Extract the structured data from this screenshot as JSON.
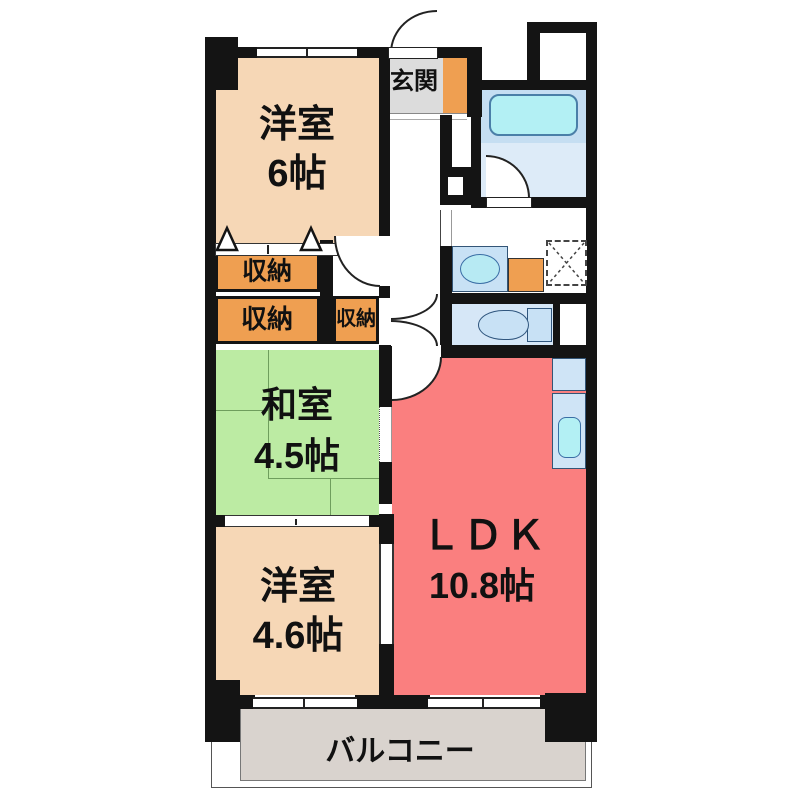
{
  "plan_title": "間取り図",
  "rooms": {
    "entrance": {
      "label": "玄関"
    },
    "western_room_6": {
      "label": "洋室",
      "size": "6帖"
    },
    "storage_1": {
      "label": "収納"
    },
    "storage_2": {
      "label": "収納"
    },
    "storage_3": {
      "label": "収納"
    },
    "japanese_room": {
      "label": "和室",
      "size": "4.5帖"
    },
    "western_room_46": {
      "label": "洋室",
      "size": "4.6帖"
    },
    "ldk": {
      "label": "ＬＤＫ",
      "size": "10.8帖"
    },
    "balcony": {
      "label": "バルコニー"
    }
  },
  "colors": {
    "wall": "#141414",
    "western_room": "#f6d7b6",
    "storage": "#ef9f51",
    "entrance_tile": "#dcdcdc",
    "japanese_room": "#bceba3",
    "ldk": "#fa7f7f",
    "balcony": "#d9d3ce",
    "bath_band": "#c5def2",
    "bath_floor": "#ddebf8",
    "tub": "#b3f0f4",
    "fixture_blue": "#c8e1f5",
    "sink_cyan": "#b7eaf3",
    "toilet_floor": "#d6e7f7",
    "counter_blue": "#cfe4f6"
  }
}
